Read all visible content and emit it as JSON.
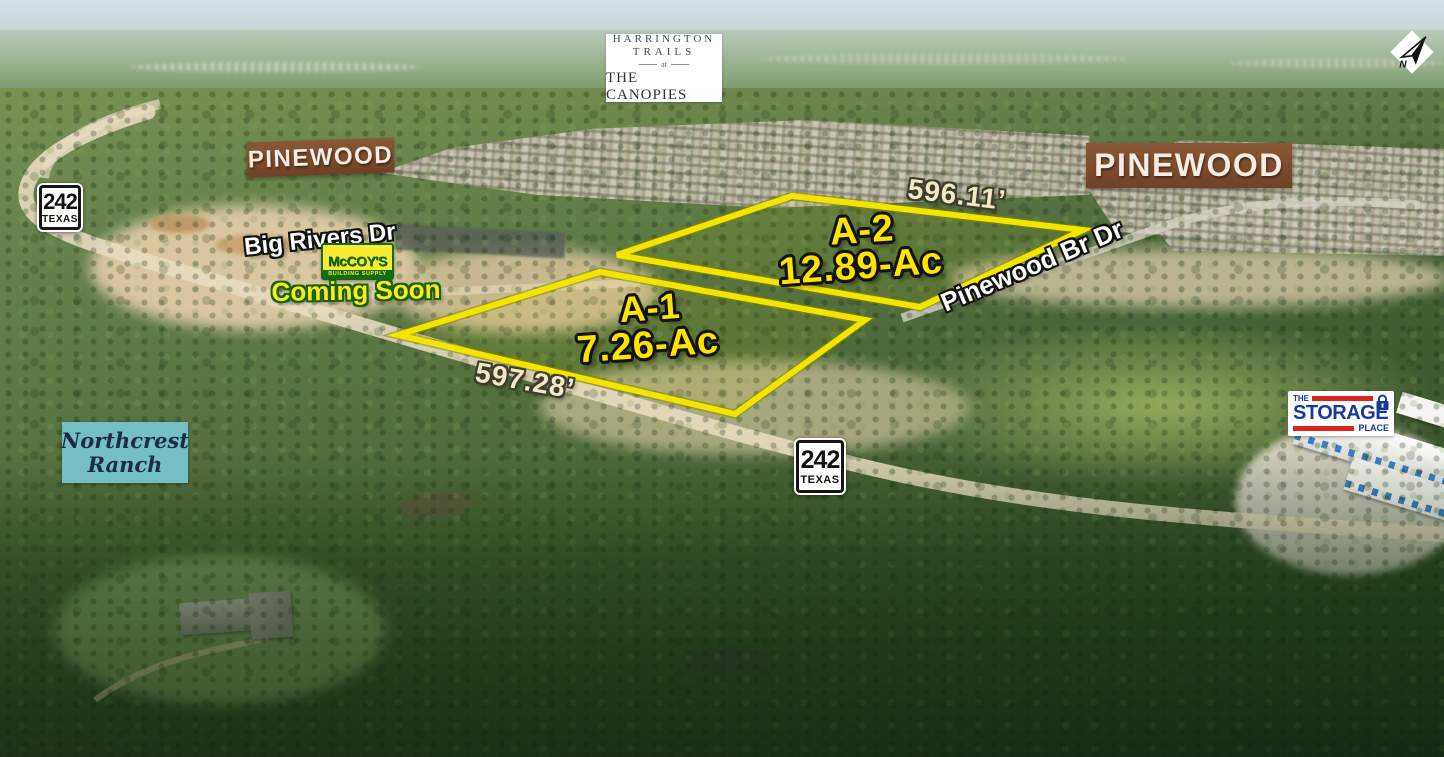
{
  "header_logo": {
    "line1": "HARRINGTON",
    "line2": "TRAILS",
    "line3": "at",
    "line4": "THE CANOPIES"
  },
  "compass": {
    "label": "N"
  },
  "shield": {
    "number": "242",
    "state": "TEXAS"
  },
  "banners": {
    "pinewood_left": "PINEWOOD",
    "pinewood_right": "PINEWOOD"
  },
  "northcrest": {
    "line1": "Northcrest",
    "line2": "Ranch"
  },
  "roads": {
    "big_rivers": "Big Rivers Dr",
    "pinewood_branch": "Pinewood Br Dr"
  },
  "mccoys": {
    "name": "McCOY'S",
    "tagline": "BUILDING SUPPLY",
    "status": "Coming Soon"
  },
  "storage": {
    "word_the": "THE",
    "word_storage": "STORAGE",
    "word_place": "PLACE"
  },
  "parcels": {
    "a2": {
      "id": "A-2",
      "acreage": "12.89-Ac",
      "frontage": "596.11’",
      "points": "792,196 1083,230 920,307 617,255"
    },
    "a1": {
      "id": "A-1",
      "acreage": "7.26-Ac",
      "frontage": "597.28’",
      "points": "600,272 865,320 735,414 398,335"
    }
  },
  "colors": {
    "parcel_outline": "#f2e600",
    "parcel_label_yellow": "#ffe400",
    "dimension_cream": "#f2e9c5",
    "banner_brown": "#7b4b2b",
    "northcrest_teal": "#73bfc3",
    "mccoys_green": "#136c13",
    "mccoys_yellow": "#f9ec33",
    "storage_blue": "#16399b",
    "storage_red": "#d9251c"
  }
}
